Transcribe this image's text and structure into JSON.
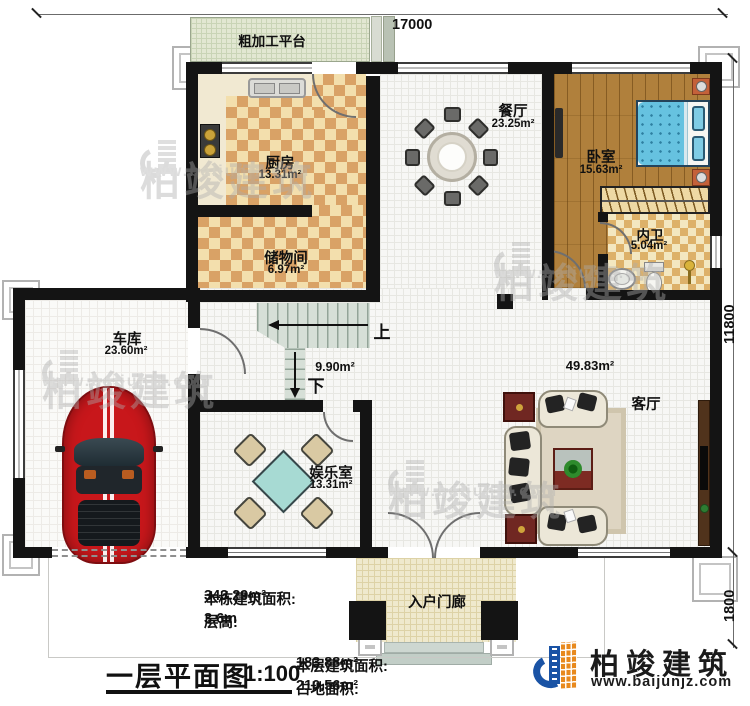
{
  "dimensions": {
    "top": "17000",
    "right_main": "11800",
    "right_porch": "1800"
  },
  "rooms": {
    "platform": {
      "name": "粗加工平台"
    },
    "kitchen": {
      "name": "厨房",
      "area": "13.31m²"
    },
    "storage": {
      "name": "储物间",
      "area": "6.97m²"
    },
    "dining": {
      "name": "餐厅",
      "area": "23.25m²"
    },
    "bedroom": {
      "name": "卧室",
      "area": "15.63m²"
    },
    "ensuite": {
      "name": "内卫",
      "area": "5.04m²"
    },
    "garage": {
      "name": "车库",
      "area": "23.60m²"
    },
    "stairhall": {
      "area": "9.90m²",
      "up": "上",
      "down": "下"
    },
    "living": {
      "name": "客厅",
      "area": "49.83m²"
    },
    "entertainment": {
      "name": "娱乐室",
      "area": "13.31m²"
    },
    "porch": {
      "name": "入户门廊"
    }
  },
  "stats": {
    "building_area_label": "本栋建筑面积:",
    "building_area_value": "343.29m²",
    "floor_height_label": "层高:",
    "floor_height_value": "3.6m",
    "floor_area_label": "本层建筑面积:",
    "floor_area_value": "183.88m²",
    "footprint_label": "占地面积:",
    "footprint_value": "210.56m²"
  },
  "titleblock": {
    "title": "一层平面图",
    "scale": "1:100"
  },
  "brand": {
    "name": "柏竣建筑",
    "url": "www.baijunjz.com"
  },
  "watermark": {
    "name": "柏竣建筑",
    "url": "www.baijunjz.com"
  },
  "colors": {
    "wall": "#141414",
    "car_red": "#c8171b",
    "bed_blue": "#66c2e0",
    "brand_blue": "#1a53a5",
    "brand_orange": "#e8891d",
    "checker_dark": "#d9a266",
    "checker_light": "#f3dfad",
    "wood": "#b0803c"
  }
}
